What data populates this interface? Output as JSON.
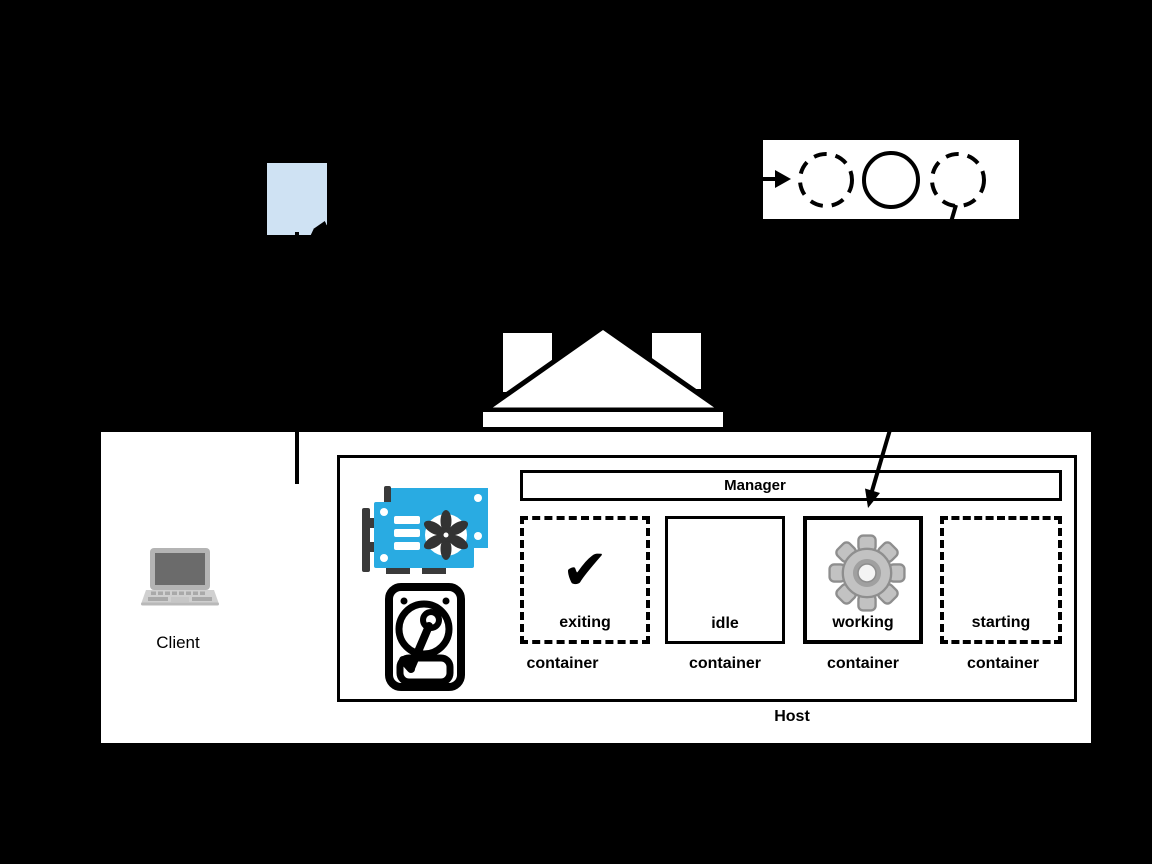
{
  "scene": {
    "background_color": "#000000",
    "document": {
      "icon": "document-icon",
      "color": "#cfe2f3"
    },
    "lifecycle_panel": {
      "circles": [
        {
          "style": "dashed"
        },
        {
          "style": "solid"
        },
        {
          "style": "dashed"
        }
      ]
    },
    "building": {
      "icon": "building-icon"
    },
    "client": {
      "label": "Client",
      "icon": "laptop-icon"
    },
    "host": {
      "label": "Host",
      "manager": {
        "label": "Manager"
      },
      "hardware": [
        {
          "icon": "gpu-icon",
          "color": "#29abe2"
        },
        {
          "icon": "hard-disk-icon"
        }
      ],
      "containers": [
        {
          "state_label": "exiting",
          "type_label": "container",
          "border_style": "dashed",
          "icon": "checkmark-icon",
          "glyph": "✔"
        },
        {
          "state_label": "idle",
          "type_label": "container",
          "border_style": "solid"
        },
        {
          "state_label": "working",
          "type_label": "container",
          "border_style": "solid",
          "icon": "gear-icon"
        },
        {
          "state_label": "starting",
          "type_label": "container",
          "border_style": "dashed"
        }
      ]
    }
  }
}
